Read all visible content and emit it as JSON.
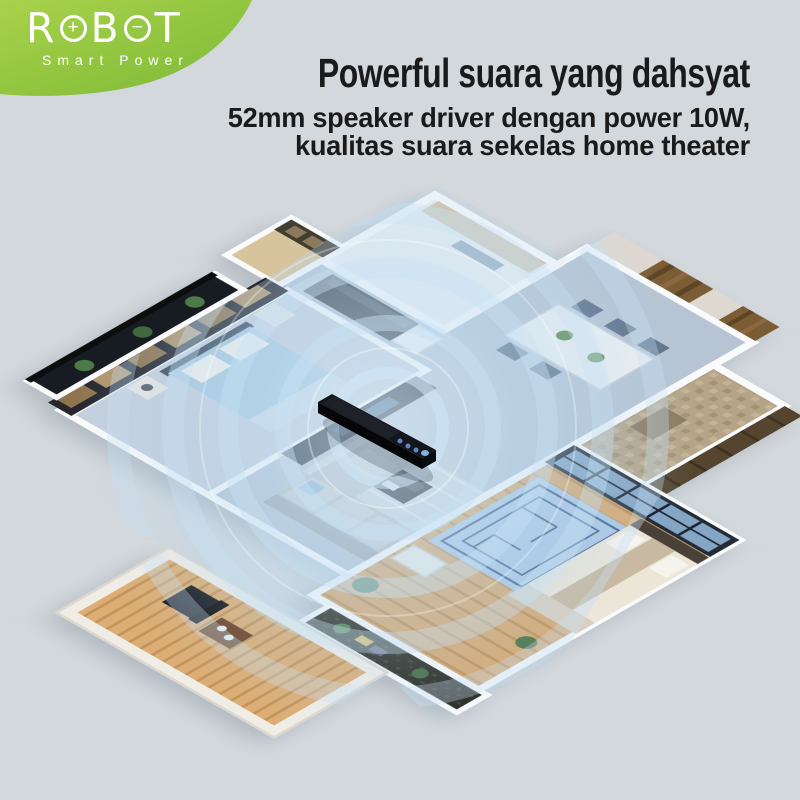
{
  "brand": {
    "name": "ROBOT",
    "letters": {
      "l1": "R",
      "sym1": "+",
      "l2": "B",
      "sym2": "−",
      "l3": "T"
    },
    "tagline": "Smart Power",
    "badge_gradient_top": "#a9d24b",
    "badge_gradient_bottom": "#7cb935"
  },
  "headline": {
    "title": "Powerful suara yang dahsyat",
    "subtitle_line1": "52mm speaker driver dengan power 10W,",
    "subtitle_line2": "kualitas suara sekelas home theater",
    "text_color": "#1a1a1a"
  },
  "scene": {
    "background_color": "#d3d8dc",
    "sound_wave_color": "#cfe7f7",
    "product": "soundbar"
  }
}
